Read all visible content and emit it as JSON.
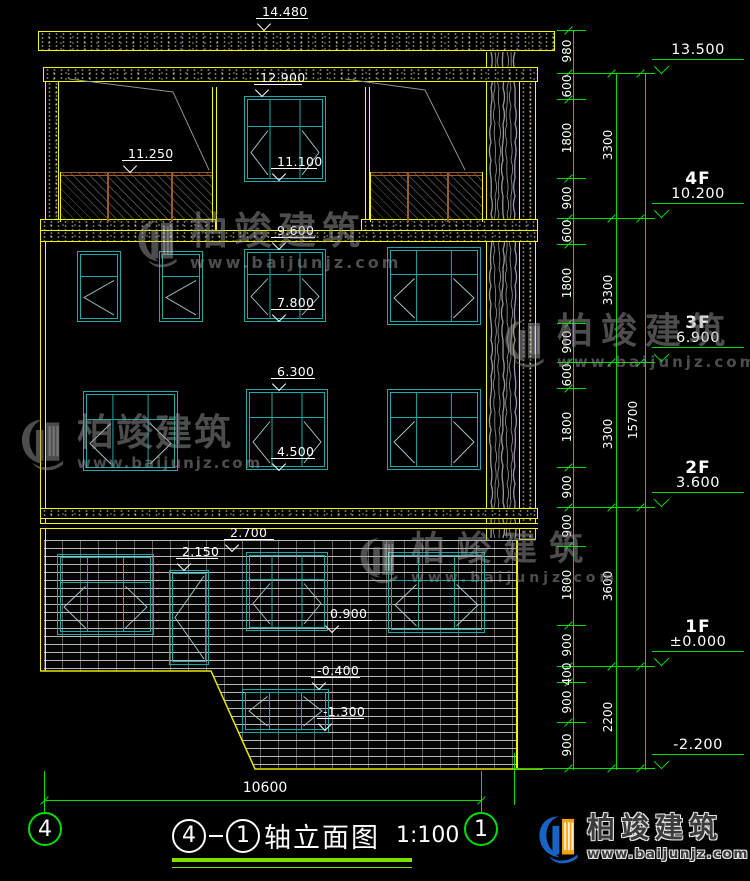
{
  "title_block": {
    "axis_from": "4",
    "axis_to": "1",
    "name": "轴立面图",
    "scale": "1:100"
  },
  "axis_bubbles": {
    "left": "4",
    "right": "1"
  },
  "bottom_dimension": "10600",
  "elevation_markers": [
    "14.480",
    "12.900",
    "11.250",
    "11.100",
    "9.600",
    "7.800",
    "6.300",
    "4.500",
    "2.700",
    "2.150",
    "0.900",
    "-0.400",
    "-1.300"
  ],
  "right_dimensions": {
    "top": "980",
    "segments": [
      "600",
      "1800",
      "900",
      "600",
      "1800",
      "900",
      "600",
      "1800",
      "900",
      "900",
      "1800",
      "900",
      "400",
      "900",
      "900"
    ],
    "story_totals": [
      "3300",
      "3300",
      "3300",
      "3600",
      "2200"
    ],
    "overall": "15700"
  },
  "floor_markers": [
    {
      "floor": "",
      "value": "13.500"
    },
    {
      "floor": "4F",
      "value": "10.200"
    },
    {
      "floor": "3F",
      "value": "6.900"
    },
    {
      "floor": "2F",
      "value": "3.600"
    },
    {
      "floor": "1F",
      "value": "±0.000"
    },
    {
      "floor": "",
      "value": "-2.200"
    }
  ],
  "watermark": {
    "brand": "柏竣建筑",
    "url": "www.baijunjz.com"
  },
  "footer_logo": {
    "brand": "柏竣建筑",
    "url": "www.baijunjz.com"
  },
  "colors": {
    "cad_yellow": "#f7f700",
    "cad_green": "#00e000",
    "window_teal": "#1fa8a8",
    "chevron_gray": "#a9cfcf",
    "dim_white": "#ffffff",
    "railing_brown": "#9c5a28",
    "watermark_gray": "#9a9a9a",
    "logo_blue": "#1763c6",
    "logo_orange": "#f5a11c"
  }
}
